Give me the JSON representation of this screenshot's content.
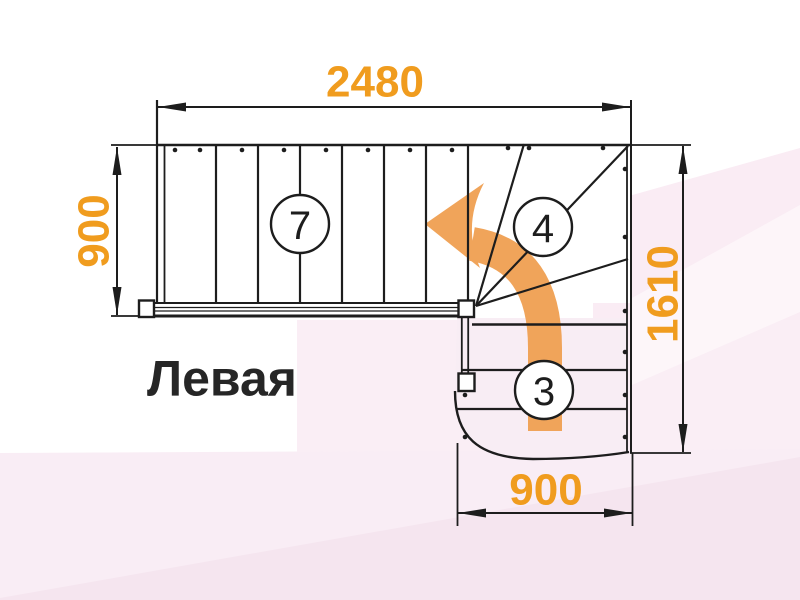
{
  "drawing": {
    "type_label": "Левая",
    "dimensions": {
      "top_width": "2480",
      "left_height": "900",
      "right_height": "1610",
      "bottom_width": "900"
    },
    "flights": {
      "upper_steps": "7",
      "winder_steps": "4",
      "lower_steps": "3"
    },
    "colors": {
      "dimension_text": "#F09C1E",
      "direction_arrow": "#F0A45A",
      "linework": "#1D1D1D",
      "background_tint": "#F9EDF5"
    }
  }
}
